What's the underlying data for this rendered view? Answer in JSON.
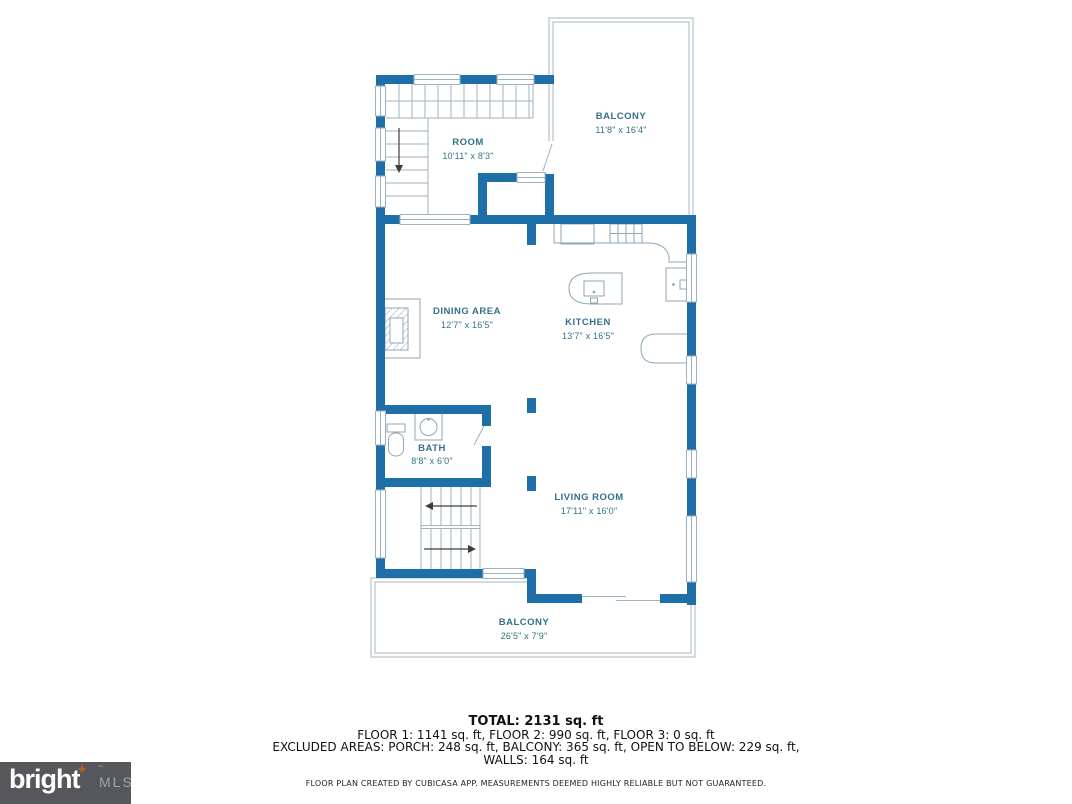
{
  "plan": {
    "rooms": [
      {
        "name": "BALCONY",
        "dims": "11'8\" x 16'4\""
      },
      {
        "name": "ROOM",
        "dims": "10'11\" x 8'3\""
      },
      {
        "name": "DINING AREA",
        "dims": "12'7\" x 16'5\""
      },
      {
        "name": "KITCHEN",
        "dims": "13'7\" x 16'5\""
      },
      {
        "name": "BATH",
        "dims": "8'8\" x 6'0\""
      },
      {
        "name": "LIVING ROOM",
        "dims": "17'11\" x 16'0\""
      },
      {
        "name": "BALCONY",
        "dims": "26'5\" x 7'9\""
      }
    ],
    "colors": {
      "wall": "#1E6FA8",
      "thin_line": "#9DB1BE",
      "label_text": "#35708A"
    }
  },
  "summary": {
    "total": "TOTAL: 2131 sq. ft",
    "floors": "FLOOR 1: 1141 sq. ft, FLOOR 2: 990 sq. ft, FLOOR 3: 0 sq. ft",
    "excluded": "EXCLUDED AREAS: PORCH: 248 sq. ft, BALCONY: 365 sq. ft, OPEN TO BELOW: 229 sq. ft,",
    "walls": "WALLS: 164 sq. ft"
  },
  "disclaimer": "FLOOR PLAN CREATED BY CUBICASA APP. MEASUREMENTS DEEMED HIGHLY RELIABLE BUT NOT GUARANTEED.",
  "logo": {
    "brand": "bright",
    "tm": "™",
    "suffix": "MLS",
    "background": "#55575B",
    "star_color": "#C05B30"
  }
}
